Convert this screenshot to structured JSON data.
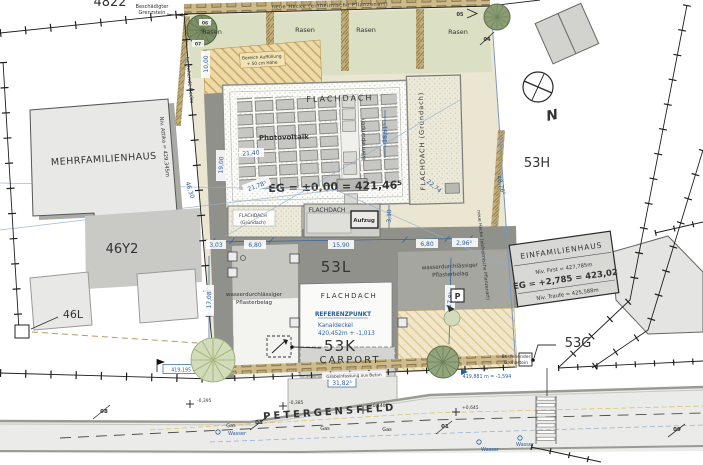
{
  "colors": {
    "dim_blue": "#2a5e9e",
    "site_beige": "#eae6d2",
    "lawn_green": "#dbe0c4",
    "paving_dark": "#91918c",
    "hedge_brown": "#c1ad7a",
    "road_gray": "#ebebe9",
    "gas_yellow": "#c09418",
    "building_gray": "#e8e8e6"
  },
  "parcels": {
    "p4822": "4822",
    "p53h": "53H",
    "p53l": "53L",
    "p53k": "53K",
    "p53g": "53G",
    "p46y2": "46Y2",
    "p46l": "46L"
  },
  "mfh": {
    "name": "MEHRFAMILIENHAUS",
    "attika": "Niv. Attika = 429,345m"
  },
  "efh": {
    "name": "EINFAMILIENHAUS",
    "first": "Niv. First = 427,785m",
    "eg": "EG = +2,785 = 423,02",
    "traufe": "Niv. Traufe = 425,588m"
  },
  "neubau": {
    "flachdach": "FLACHDACH",
    "gruendach1": "FLACHDACH",
    "gruendach2": "(Gründach)",
    "gruendach_vert": "FLACHDACH (Gründach)",
    "photovoltaik": "Photovoltaik",
    "waermepumpen": "Wärmepumpen",
    "aufzug": "Aufzug",
    "carport": "CARPORT",
    "eg": "EG = ±0,00 = 421,46⁵"
  },
  "referenz": {
    "l1": "REFERENZPUNKT",
    "l2": "Kanaldeckel",
    "l3": "420,452m + -1,013"
  },
  "benchmarks": {
    "left": "419,195 m = -2,26",
    "right": "419,881 m = -1,594"
  },
  "spot": {
    "s1": "-0,395",
    "s2": "-0,385",
    "s3": "+0,140",
    "s4": "+0,645"
  },
  "dims": {
    "d1000": "10,00",
    "d1900": "19,00",
    "d2140": "21,40",
    "d2178": "21,78⁵",
    "d1851": "18,51⁵",
    "d2274": "22,74",
    "d4630": "46,30",
    "d4876": "48,76⁵",
    "d303": "3,03",
    "d680": "6,80",
    "d1590": "15,90",
    "d296": "2,96⁵",
    "d310": "3,10",
    "d1708": "17,08",
    "d1785": "17,8⁵",
    "d3182": "31,82⁵"
  },
  "site": {
    "rasen": "Rasen",
    "neue_hecke": "neue Hecke (einheimische Pflanzenart)",
    "bestehende_hecke": "bestehende Hecke",
    "p_sign": "P",
    "north": "N"
  },
  "annotations": {
    "beschaedigter1": "Beschädigter",
    "beschaedigter2": "Grenzstein",
    "bestehender1": "Bestehender",
    "bestehender2": "Grenzstein",
    "bereich1": "Bereich Auffüllung",
    "bereich2": "+ 50 cm Höhe",
    "wasserdurch1": "wasserdurchlässiger",
    "wasserdurch2": "Pflasterbelag",
    "einfassung": "Grabeinfassung aus Beton"
  },
  "road": {
    "name": "PETERGENSFELD",
    "gas": "Gas",
    "wasser": "Wasser",
    "m01": "01",
    "m03": "03",
    "m08": "08",
    "m09": "09"
  },
  "tree_markers": {
    "t04": "04",
    "t05": "05",
    "t06": "06",
    "t07": "07"
  }
}
